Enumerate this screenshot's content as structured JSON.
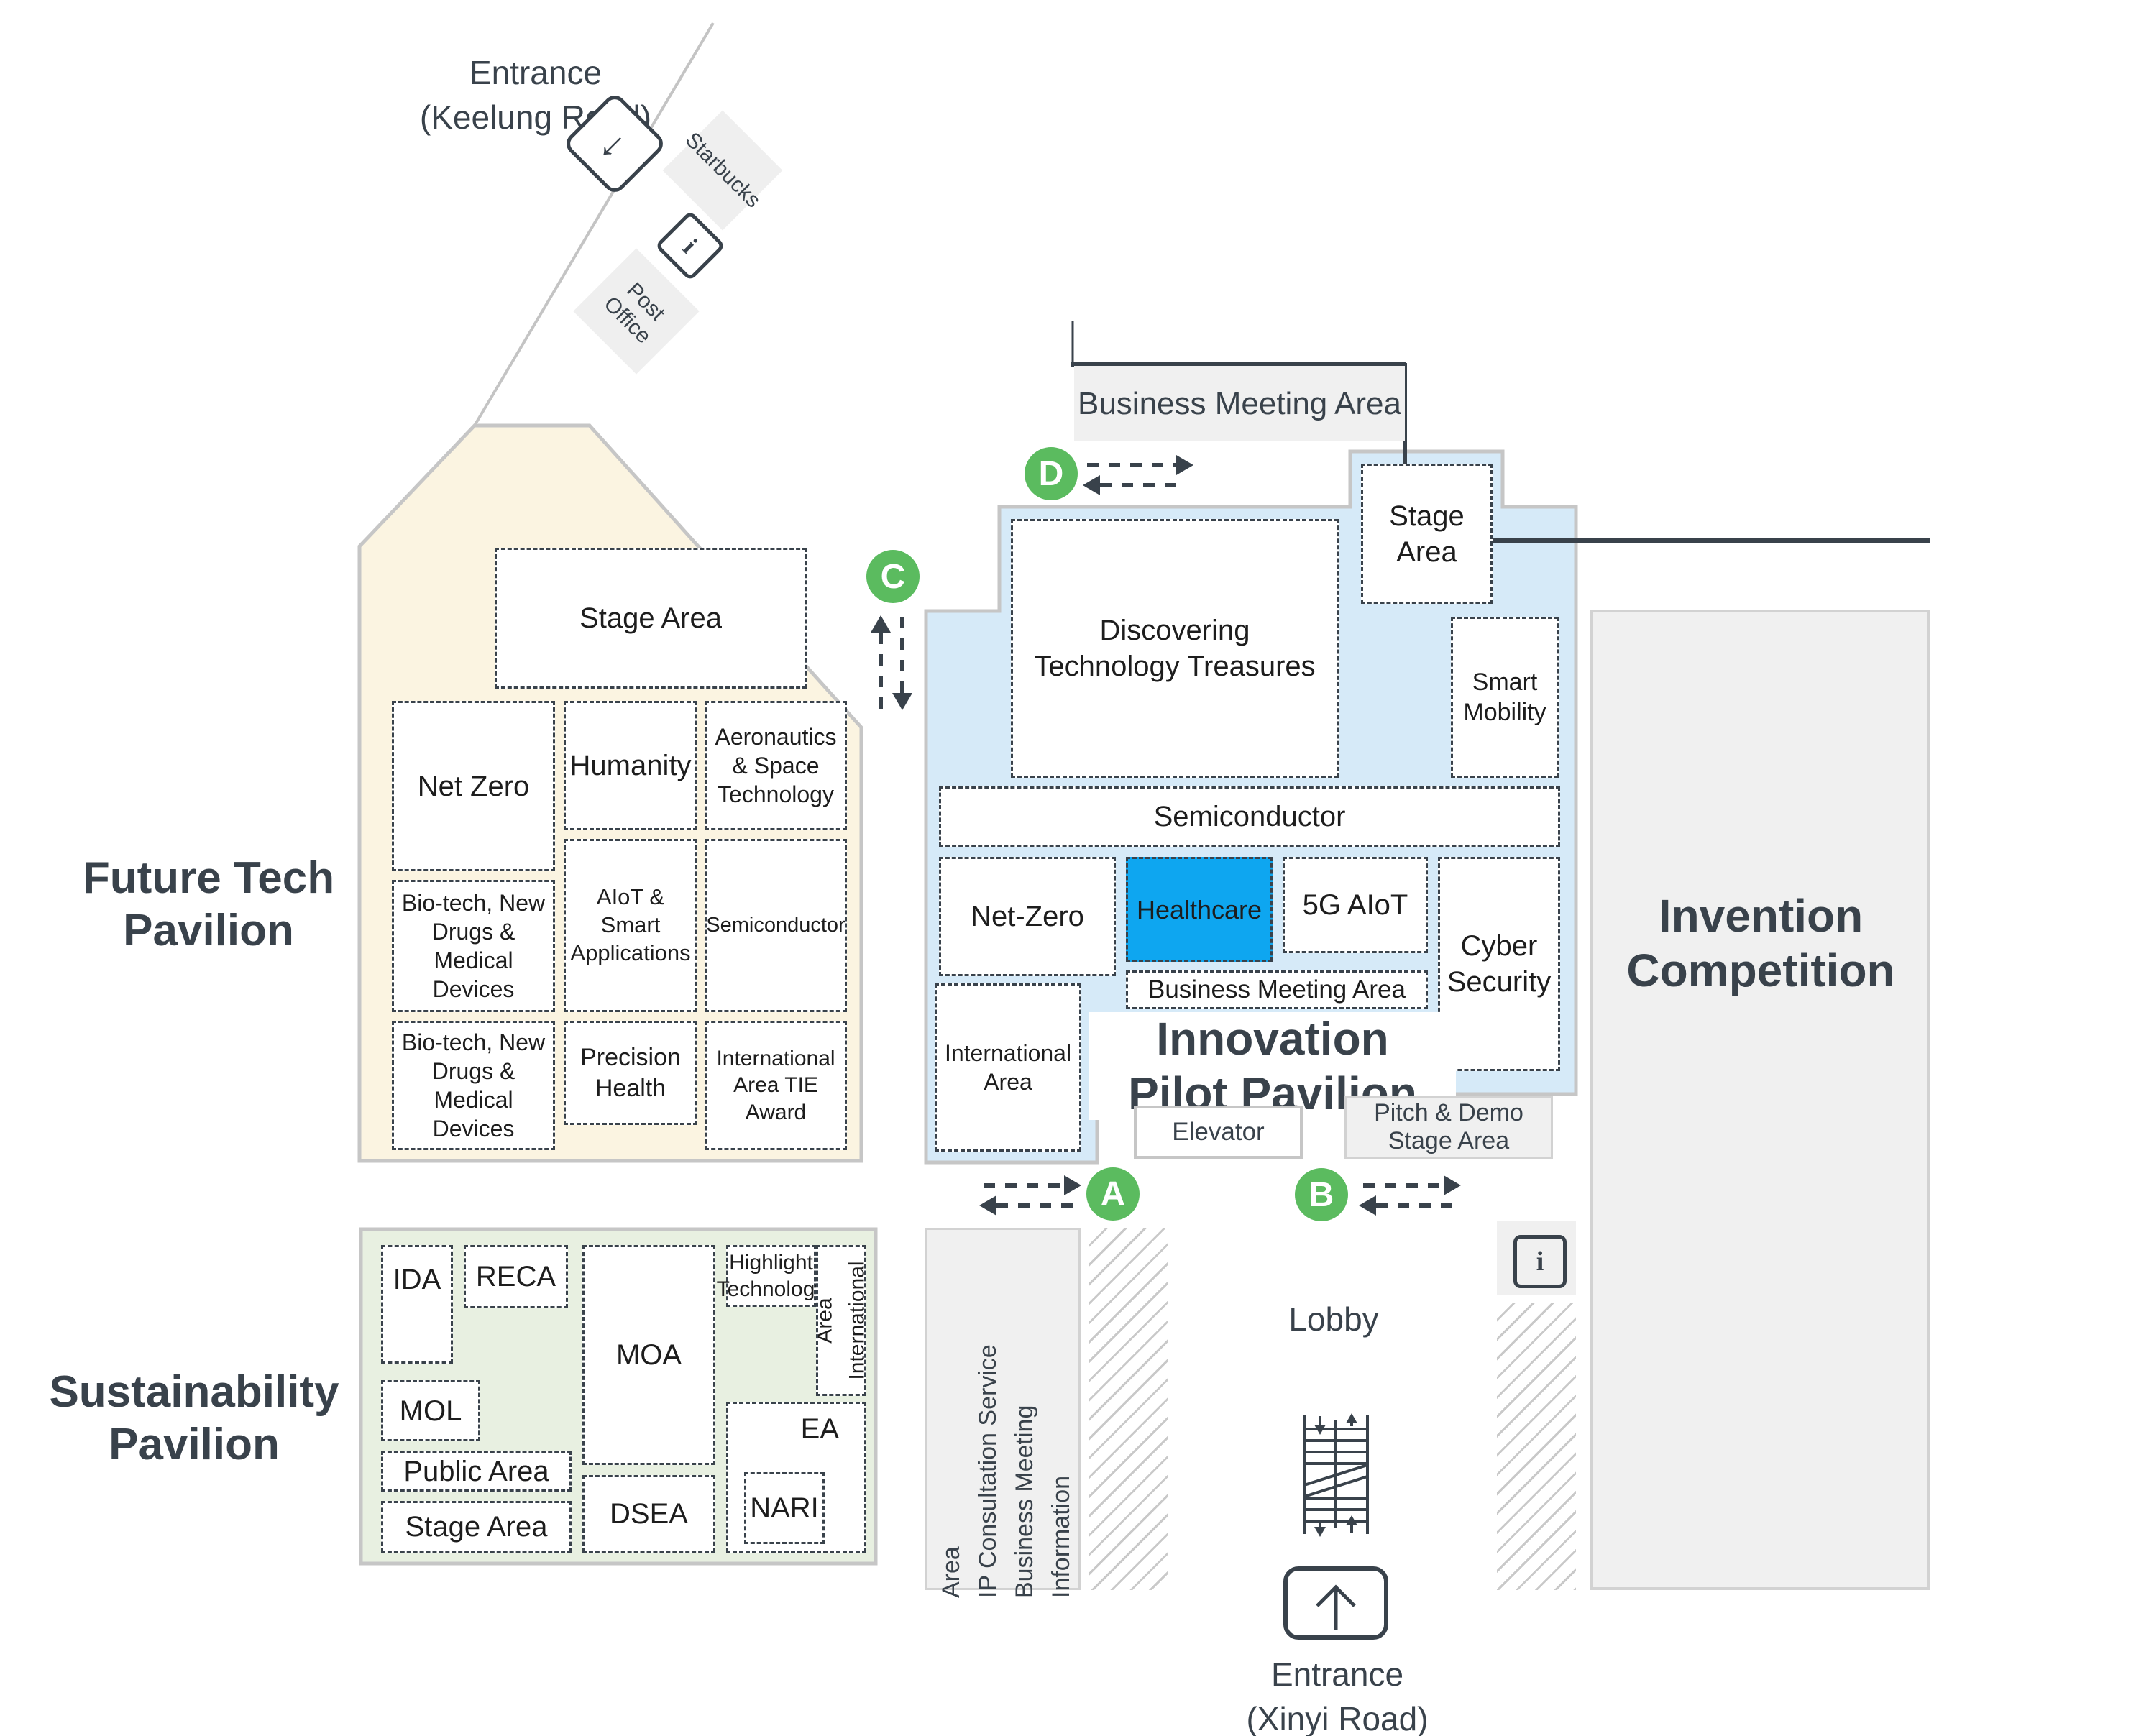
{
  "colors": {
    "future_tech_fill": "#FBF4E1",
    "innovation_fill": "#D6EAF8",
    "sustainability_fill": "#E8F0E1",
    "healthcare_fill": "#0EA6F0",
    "marker_green": "#5BBB5F",
    "gray_area": "#F0F0F0",
    "dark": "#39424B"
  },
  "keelung_entrance": {
    "line1": "Entrance",
    "line2": "(Keelung Road)"
  },
  "landmarks": {
    "starbucks": "Starbucks",
    "post_office": "Post Office"
  },
  "business_meeting_area_top": "Business Meeting Area",
  "markers": {
    "a": "A",
    "b": "B",
    "c": "C",
    "d": "D"
  },
  "icons": {
    "info": "i",
    "entrance_arrow": "↓"
  },
  "future_tech": {
    "title_line1": "Future Tech",
    "title_line2": "Pavilion",
    "rooms": {
      "stage": "Stage Area",
      "net_zero": "Net Zero",
      "humanity": "Humanity",
      "aero": "Aeronautics & Space Technology",
      "biotech1": "Bio-tech, New Drugs & Medical Devices",
      "aiot": "AIoT & Smart Applications",
      "semiconductor": "Semiconductor",
      "biotech2": "Bio-tech, New Drugs & Medical Devices",
      "precision": "Precision Health",
      "international": "International Area TIE Award"
    }
  },
  "innovation": {
    "title_line1": "Innovation",
    "title_line2": "Pilot Pavilion",
    "rooms": {
      "stage": "Stage Area",
      "discovering": "Discovering Technology Treasures",
      "smart_mobility": "Smart Mobility",
      "semiconductor": "Semiconductor",
      "net_zero": "Net-Zero",
      "healthcare": "Healthcare",
      "five_g_aiot": "5G AIoT",
      "cyber": "Cyber Security",
      "business_meeting": "Business Meeting Area",
      "intl_line1": "International",
      "intl_line2": "Area"
    },
    "elevator": "Elevator",
    "pitch_demo": "Pitch & Demo Stage Area"
  },
  "sustainability": {
    "title_line1": "Sustainability",
    "title_line2": "Pavilion",
    "rooms": {
      "ida": "IDA",
      "reca": "RECA",
      "mol": "MOL",
      "public": "Public Area",
      "stage": "Stage Area",
      "moa": "MOA",
      "dsea": "DSEA",
      "highlight": "Highlight Technology",
      "intl_line1": "International",
      "intl_line2": "Area",
      "ea": "EA",
      "nari": "NARI"
    }
  },
  "invention": {
    "line1": "Invention",
    "line2": "Competition"
  },
  "bottom": {
    "lobby": "Lobby",
    "entrance_line1": "Entrance",
    "entrance_line2": "(Xinyi Road)",
    "info_lines": [
      "Information",
      "Business Meeting",
      "IP Consultation Service",
      "Area"
    ]
  }
}
